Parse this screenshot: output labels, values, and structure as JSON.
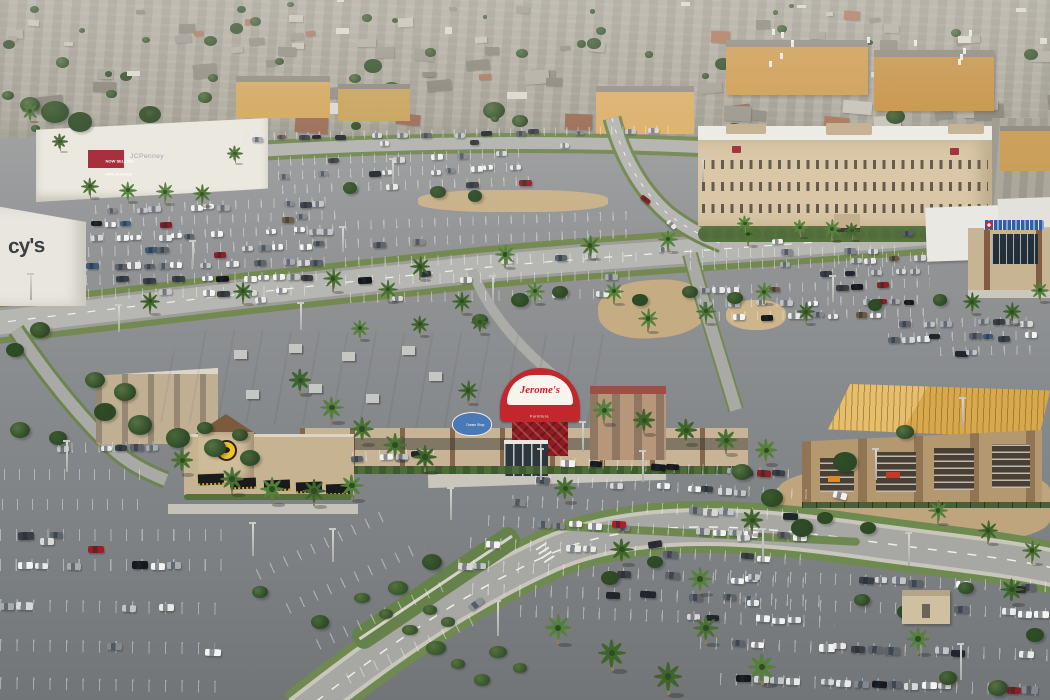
{
  "scene": {
    "type": "aerial-photograph",
    "subject": "Elevated daytime view of a Southern California shopping center: Jerome's Furniture big-box store, Buffalo Wild Wings restaurant, JCPenney and Macy's mall anchors, a tan hotel, a building under construction, large parking lots with scattered cars, palm trees, and dense suburban housing on the horizon"
  },
  "signs": {
    "macys_partial": "cy's",
    "jcpenney": "JCPenney",
    "banner1": "NOW SELLING",
    "banner2": "APPLIANCES!",
    "jeromes": "Jerome's",
    "jeromes_sub": "Furniture",
    "dream_shop": "Dream Shop",
    "bww": "BUFFALO WILD WINGS"
  },
  "palette": {
    "asphalt": "#8f9192",
    "road": "#b6b6b2",
    "roof_white": "#efeeea",
    "stucco": "#c7b496",
    "jeromes_red": "#c2272d",
    "banner_red": "#a32030",
    "bww_yellow": "#f2c32a",
    "hotel_tan": "#d8c5a4",
    "plywood": "#d7a94e",
    "dream_blue": "#4a7ab5",
    "sign_blue": "#2d59a8",
    "grass": "#6f8a51",
    "car_colors": [
      "#f3f3f1",
      "#e9e9e7",
      "#d7d8d6",
      "#c2c5c8",
      "#a6abb0",
      "#83888d",
      "#5f646a",
      "#3b3f44",
      "#22252a",
      "#16181b",
      "#8e2025",
      "#3d5a7a",
      "#6b5a44"
    ],
    "housing_roofs": [
      "#9a958b",
      "#8e897f",
      "#a49e93",
      "#aa7257",
      "#996851",
      "#b1aba0",
      "#878177",
      "#c7c2b8"
    ],
    "greens": [
      "#3c5a30",
      "#49673a",
      "#557244",
      "#2f4d27"
    ]
  }
}
